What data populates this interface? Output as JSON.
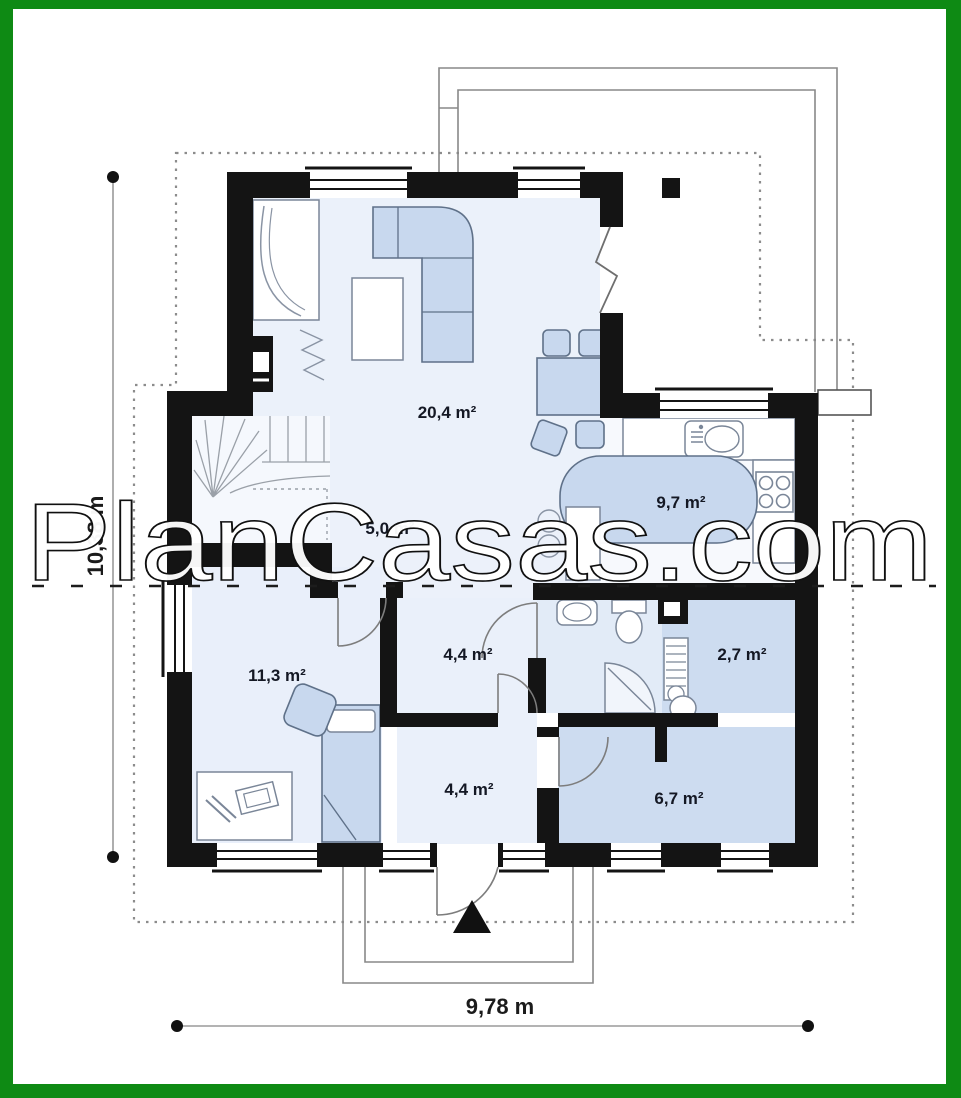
{
  "watermark": {
    "text": "PlanCasas.com"
  },
  "dimensions": {
    "width": "9,78 m",
    "height": "10,38 m"
  },
  "rooms": [
    {
      "name": "living-dining-room",
      "area": "20,4 m²"
    },
    {
      "name": "kitchen",
      "area": "9,7 m²"
    },
    {
      "name": "corridor",
      "area": "5,0 m²"
    },
    {
      "name": "hall-upper",
      "area": "4,4 m²"
    },
    {
      "name": "bedroom",
      "area": "11,3 m²"
    },
    {
      "name": "wc",
      "area": "2,7 m²"
    },
    {
      "name": "hall-lower",
      "area": "4,4 m²"
    },
    {
      "name": "utility-room",
      "area": "6,7 m²"
    }
  ],
  "colors": {
    "frame_green": "#0e8a14",
    "wall_black": "#141414",
    "furniture_blue": "#c8d8ee",
    "floor_light": "#ebf1fa",
    "floor_medium": "#cddcf0"
  }
}
